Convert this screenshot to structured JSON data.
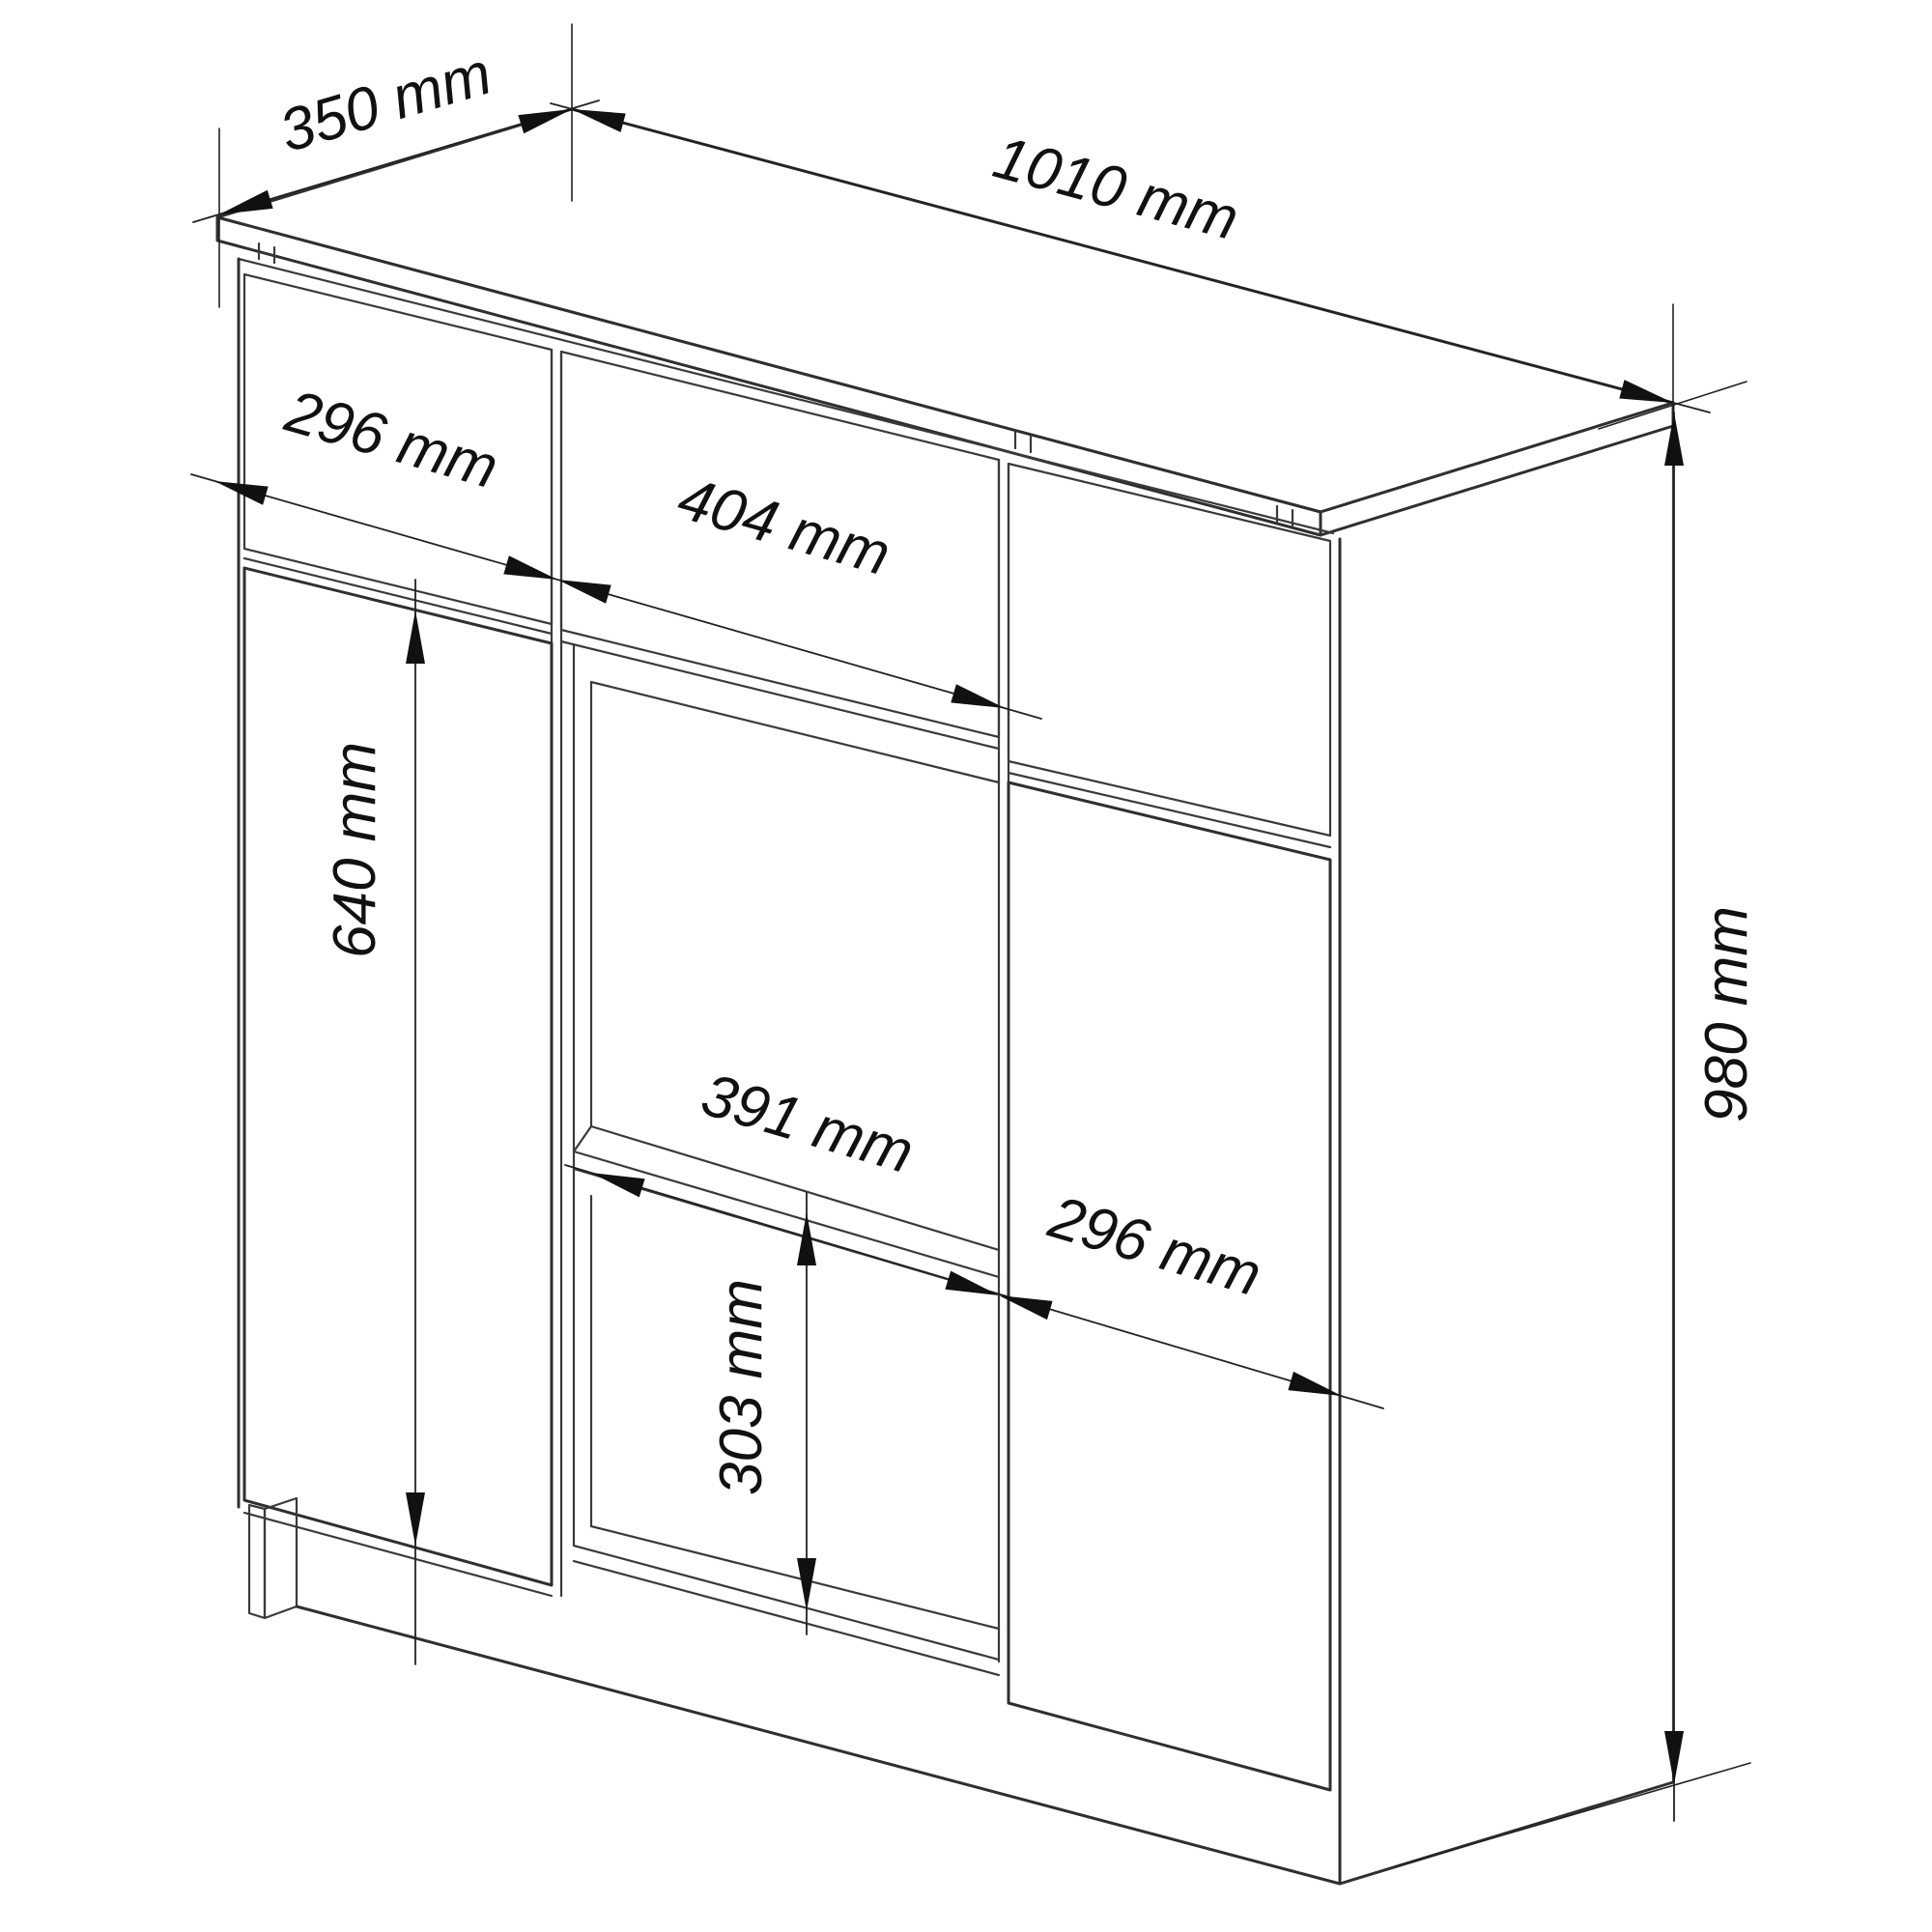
{
  "diagram": {
    "title": "cabinet-dimension-drawing",
    "unit": "mm",
    "dimensions": {
      "top_depth": "350 mm",
      "total_width": "1010 mm",
      "left_drawer_width": "296 mm",
      "middle_drawer_width": "404 mm",
      "left_door_height": "640 mm",
      "shelf_width": "391 mm",
      "right_door_width": "296 mm",
      "niche_height": "303 mm",
      "total_height": "980 mm"
    },
    "colors": {
      "line": "#2f2f2f",
      "dimension_line": "#222222",
      "text": "#111111",
      "background": "#ffffff"
    }
  }
}
